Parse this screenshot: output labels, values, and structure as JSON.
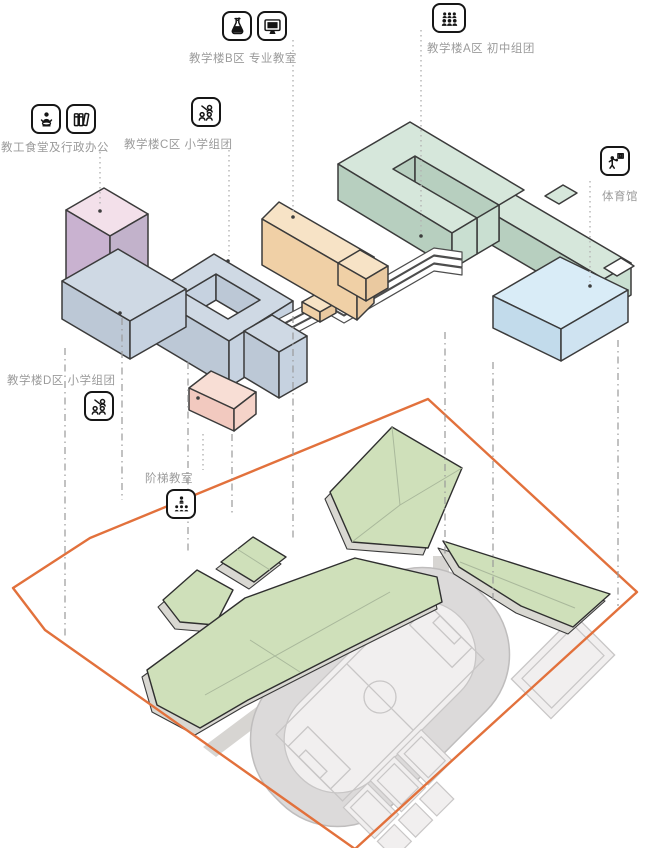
{
  "labels": {
    "building_b": {
      "text": "教学楼B区 专业教室"
    },
    "building_a": {
      "text": "教学楼A区 初中组团"
    },
    "canteen_admin": {
      "text": "教工食堂及行政办公"
    },
    "building_c": {
      "text": "教学楼C区 小学组团"
    },
    "building_d": {
      "text": "教学楼D区 小学组团"
    },
    "lecture_hall": {
      "text": "阶梯教室"
    },
    "gymnasium": {
      "text": "体育馆"
    }
  },
  "icon_map": {
    "building_b": [
      "flask-icon",
      "monitor-icon"
    ],
    "building_a": [
      "people-group-icon"
    ],
    "canteen_admin": [
      "dining-person-icon",
      "binders-icon"
    ],
    "building_c": [
      "teacher-students-icon"
    ],
    "building_d": [
      "teacher-students-icon"
    ],
    "lecture_hall": [
      "lecture-audience-icon"
    ],
    "gymnasium": [
      "basketball-player-icon"
    ]
  },
  "colors": {
    "building_a": {
      "top": "#d6e7db",
      "left": "#b7cfbf",
      "right": "#c9dfd1"
    },
    "building_b": {
      "top": "#f7e3c6",
      "left": "#f0d0a6",
      "right": "#eac9a0"
    },
    "building_cd": {
      "top": "#cfd9e4",
      "left": "#bcc8d6",
      "right": "#c6d2e0"
    },
    "canteen_tower": {
      "top": "#f3e0ea",
      "left": "#c9b2d0",
      "right": "#c2b2cb"
    },
    "lecture_hall": {
      "top": "#f8ded5",
      "left": "#f2c9bf",
      "right": "#f5d3c9"
    },
    "gymnasium": {
      "top": "#d9ecf7",
      "left": "#c2dbeb",
      "right": "#cfe3f1"
    },
    "white_bridge": "#ffffff",
    "site_boundary": "#e2713c",
    "site_green": "#cfe0ba",
    "site_green_edge": "#d9d8d2",
    "track_gray": "#dcdada",
    "field_gray": "#f1efef",
    "path_gray": "#d7d5d2",
    "outline": "#3b3b3b",
    "label_text": "#9b9b9b"
  }
}
